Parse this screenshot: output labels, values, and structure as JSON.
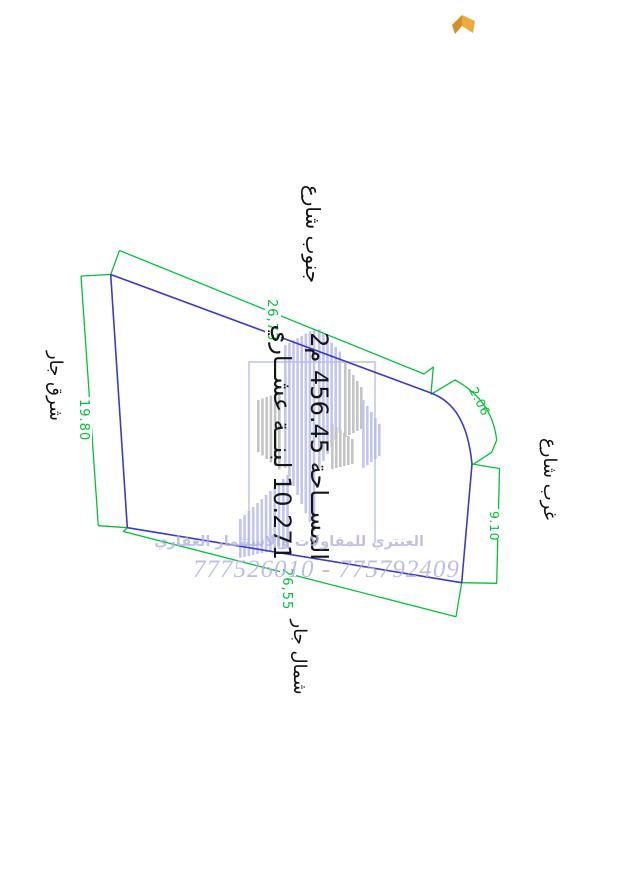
{
  "page": {
    "background": "#ffffff"
  },
  "plot": {
    "boundary_color": "#3b3bcc",
    "dimension_color": "#00c437",
    "dimensions": {
      "south_street_side": "26,73",
      "east_side": "19.80",
      "corner_arc": "2.06",
      "west_side": "9.10",
      "north_side": "26,55"
    },
    "labels": {
      "south": "جنوب شارع",
      "east": "شرق جار",
      "west": "غرب شارع",
      "north": "شمال جار"
    },
    "area": {
      "line1": "المســاحة 456.45 م2",
      "line2": "10.271 لبنــة عشــاري"
    }
  },
  "watermark": {
    "company": "العنتري للمقاولات والاستثمار العقاري",
    "phones": "777526010 - 775792409",
    "text_color": "#b2b2e2",
    "logo_bar_primary": "#b3b9ea",
    "logo_bar_secondary": "#b6b6b6"
  },
  "decoration": {
    "book_icon_color_light": "#eeaa3e",
    "book_icon_color_dark": "#d88f2a"
  }
}
